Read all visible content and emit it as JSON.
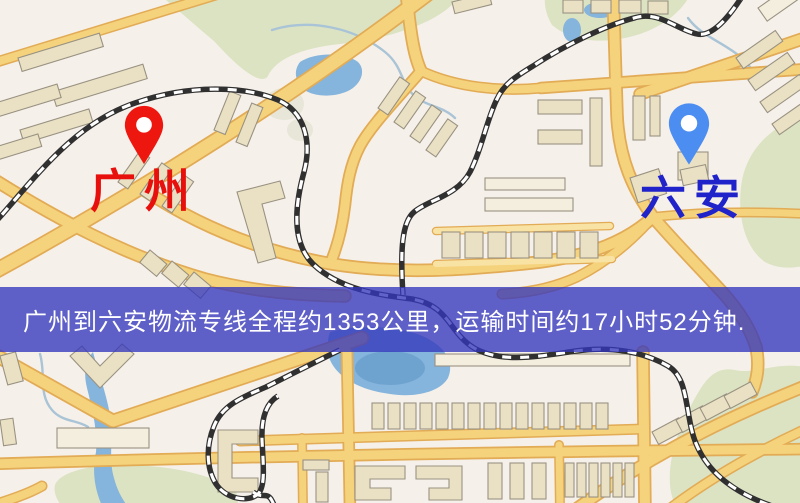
{
  "banner": {
    "text": "广州到六安物流专线全程约1353公里，运输时间约17小时52分钟.",
    "distance_km": "1353",
    "duration": "17小时52分钟"
  },
  "markers": {
    "origin": {
      "label": "广州"
    },
    "destination": {
      "label": "六安"
    }
  },
  "positions": {
    "origin_pin": {
      "x": 122,
      "y": 104
    },
    "origin_label": {
      "x": 90,
      "y": 168
    },
    "destination_pin": {
      "x": 666,
      "y": 100
    },
    "destination_label": {
      "x": 640,
      "y": 175
    }
  },
  "colors": {
    "map_bg": "#f6f0ea",
    "road_fill": "#f5d27c",
    "road_casing": "#e2ab55",
    "road_minor": "#f8e3a4",
    "building_fill": "#eae1c4",
    "building_fill_alt": "#f3eedd",
    "building_stroke": "#999282",
    "green": "#dce3c3",
    "green_alt": "#e7e6d8",
    "water": "#85b4dc",
    "water_deep": "#6fa3cf",
    "stream": "#a9c4d6",
    "railway": "#303030",
    "rail_dash": "#ffffff",
    "banner_bg": "rgba(52,55,189,0.78)",
    "banner_text": "#ffffff",
    "origin_label": "#e8100c",
    "destination_label": "#2023c9",
    "origin_marker": "#ee1710",
    "destination_marker": "#4c8df2",
    "pin_hole": "#ffffff"
  }
}
